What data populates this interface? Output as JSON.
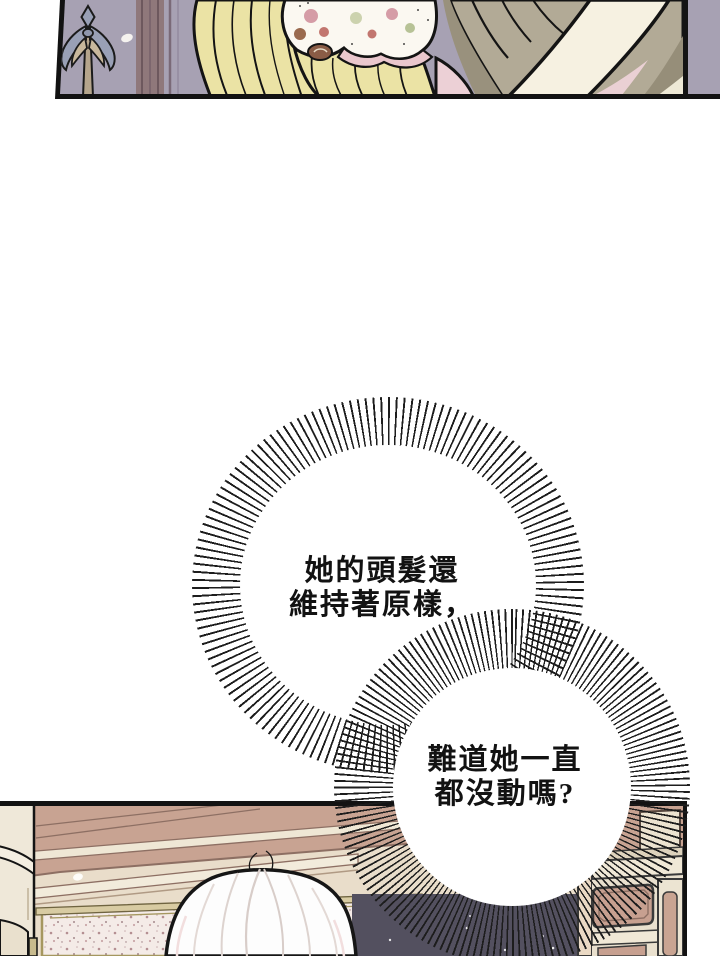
{
  "comic": {
    "bubble1": {
      "line1": "她的頭髮還",
      "line2": "維持著原樣，"
    },
    "bubble2": {
      "line1": "難道她一直",
      "line2": "都沒動嗎?"
    }
  },
  "colors": {
    "page_bg": "#ffffff",
    "ink": "#141414",
    "top_panel_wall": "#a7a1b3",
    "wall_stripe": "#8f787b",
    "hair_blonde": "#ebe3a5",
    "scrunchie_white": "#fbf8f1",
    "scrunchie_pink": "#eac7cd",
    "skin_cream": "#f6f1e1",
    "clothing_khaki": "#b2aa96",
    "pink_fabric": "#ecd0d6",
    "bottom_wall_rose": "#c8a392",
    "bottom_wall_beige": "#e9ddca",
    "molding_cream": "#f2ebdb",
    "marble": "#f4ebe7",
    "marble_trim_olive": "#a5975f",
    "window_night": "#53505f",
    "hair_white": "#fdfdfd"
  }
}
